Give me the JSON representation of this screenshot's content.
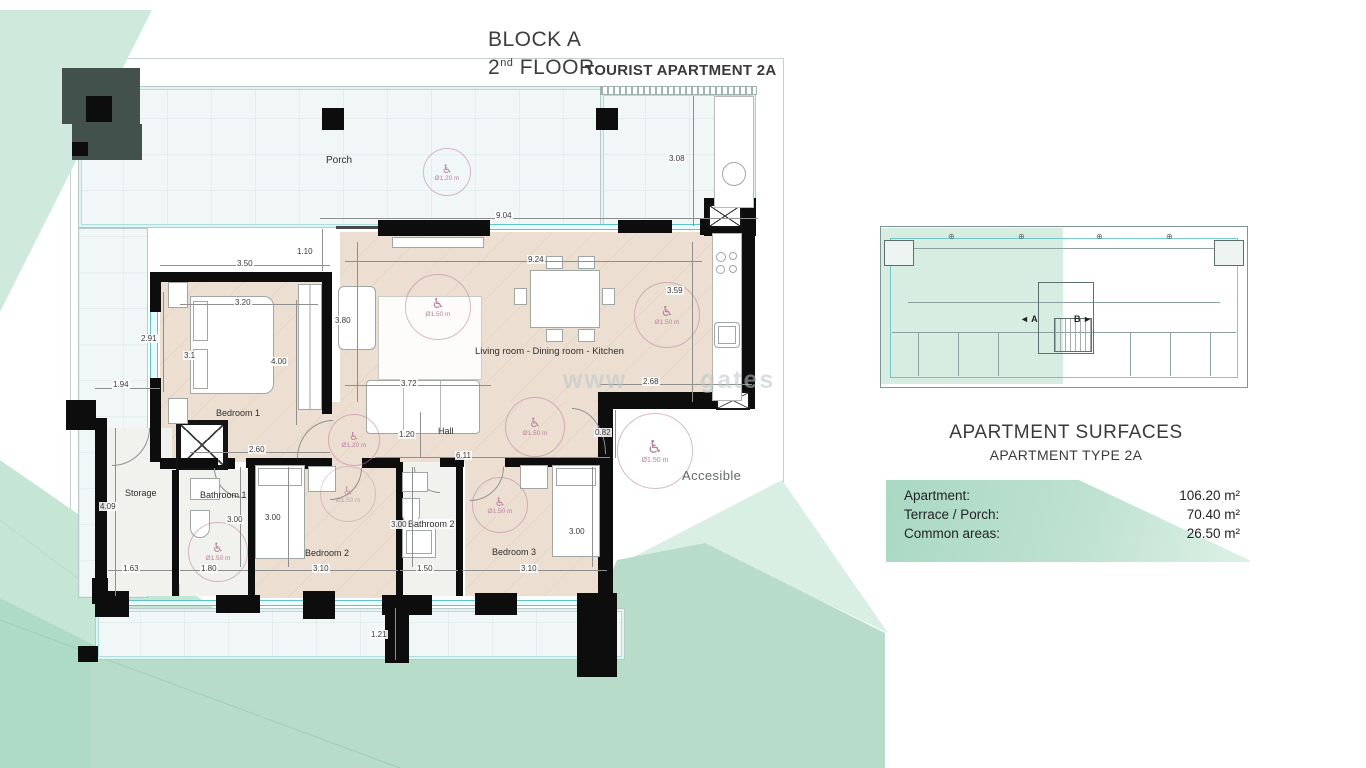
{
  "title": {
    "block": "BLOCK A",
    "floor_number": "2",
    "floor_ordinal": "nd",
    "floor_word": " FLOOR",
    "apartment_type": "TOURIST APARTMENT 2A"
  },
  "rooms": {
    "porch": "Porch",
    "living": "Living room - Dining room - Kitchen",
    "bedroom1": "Bedroom 1",
    "bedroom2": "Bedroom 2",
    "bedroom3": "Bedroom 3",
    "bathroom1": "Bathroom 1",
    "bathroom2": "Bathroom 2",
    "storage": "Storage",
    "hall": "Hall",
    "accessible": "Accesible"
  },
  "accessibility": {
    "porch_diameter": "Ø1.20 m",
    "standard_diameter": "Ø1.50 m",
    "wheelchair_icon": "♿"
  },
  "dims": [
    "9.04",
    "1.10",
    "3.50",
    "3.08",
    "9.24",
    "3.80",
    "3.20",
    "2.91",
    "3.1",
    "4.00",
    "1.94",
    "3.72",
    "3.59",
    "2.68",
    "2.60",
    "1.20",
    "6.11",
    "0.82",
    "4.09",
    "3.00",
    "3.00",
    "3.00",
    "3.00",
    "1.63",
    "1.80",
    "3.10",
    "1.50",
    "3.10",
    "1.21"
  ],
  "keyplan": {
    "unit_a": "◄ A",
    "unit_b": "B ►"
  },
  "surfaces": {
    "heading": "APARTMENT SURFACES",
    "subheading": "APARTMENT TYPE 2A",
    "rows": [
      {
        "label": "Apartment:",
        "value": "106.20 m²"
      },
      {
        "label": "Terrace / Porch:",
        "value": "70.40 m²"
      },
      {
        "label": "Common areas:",
        "value": "26.50 m²"
      }
    ]
  },
  "watermark": {
    "left": "www",
    "right": "gates"
  },
  "colors": {
    "mint_light": "#cfeadd",
    "mint": "#b7ddca",
    "mint_dark": "#a9d8c2",
    "banner_start": "#a9d8c3",
    "banner_end": "#ddf1e6",
    "floor_beige": "#ecdfd1",
    "porch_floor": "#f1f7f6",
    "wall_black": "#0d0d0d",
    "glazing_teal": "#5fc3c8",
    "accessibility_pink": "#b77f9e",
    "keyplan_teal": "#57bcc2"
  }
}
